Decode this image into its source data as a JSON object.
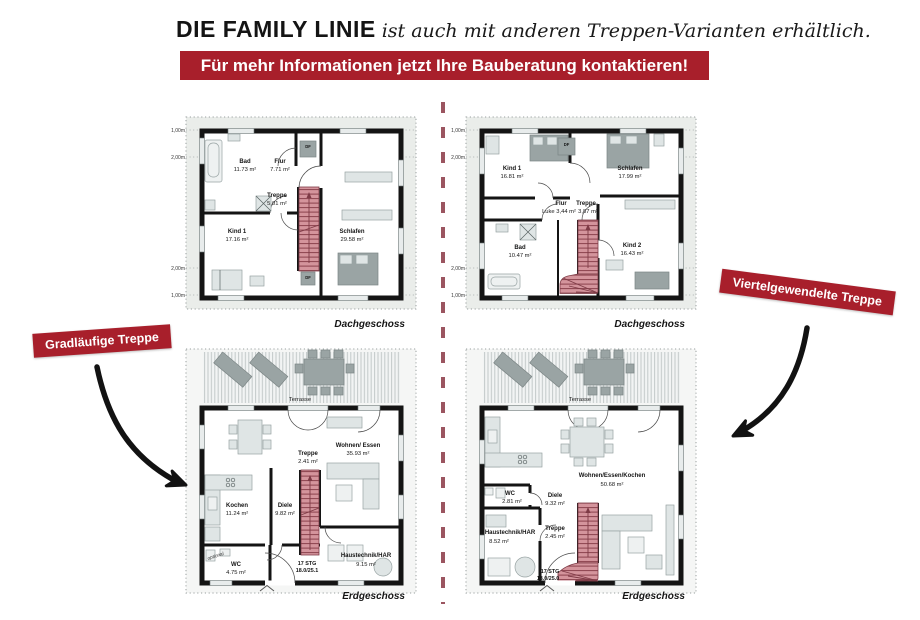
{
  "header": {
    "brand": "DIE FAMILY LINIE",
    "tagline": "ist auch mit anderen Treppen-Varianten erhältlich.",
    "banner": "Für mehr Informationen jetzt Ihre Bauberatung kontaktieren!"
  },
  "callouts": {
    "left": "Gradläufige Treppe",
    "right": "Viertelgewendelte Treppe"
  },
  "colors": {
    "accent_red": "#a81f2b",
    "stair_pink": "#d4949c",
    "divider_red": "#9b5560"
  },
  "plans": {
    "top_left": {
      "caption": "Dachgeschoss",
      "dims": [
        "1,00m",
        "2,00m",
        "2,00m",
        "1,00m"
      ],
      "roof_window": "DF",
      "rooms": {
        "bad": {
          "name": "Bad",
          "area": "11.73 m²"
        },
        "flur": {
          "name": "Flur",
          "area": "7.71 m²"
        },
        "treppe": {
          "name": "Treppe",
          "area": "5.01 m²"
        },
        "kind1": {
          "name": "Kind 1",
          "area": "17.16 m²"
        },
        "schlafen": {
          "name": "Schlafen",
          "area": "29.58 m²"
        }
      }
    },
    "top_right": {
      "caption": "Dachgeschoss",
      "dims": [
        "1,00m",
        "2,00m",
        "2,00m",
        "1,00m"
      ],
      "roof_window": "DF",
      "rooms": {
        "kind1": {
          "name": "Kind 1",
          "area": "16.81 m²"
        },
        "schlafen": {
          "name": "Schlafen",
          "area": "17.99 m²"
        },
        "flur": {
          "name": "Flur",
          "area": "Luke 3,44 m²"
        },
        "treppe": {
          "name": "Treppe",
          "area": "3,87 m²"
        },
        "bad": {
          "name": "Bad",
          "area": "10.47 m²"
        },
        "kind2": {
          "name": "Kind 2",
          "area": "16.43 m²"
        }
      }
    },
    "bottom_left": {
      "caption": "Erdgeschoss",
      "terrace": "Terrasse",
      "stair_steps": "17 STG",
      "stair_dims": "18.0/25.1",
      "rooms": {
        "kochen": {
          "name": "Kochen",
          "area": "11.24 m²"
        },
        "diele": {
          "name": "Diele",
          "area": "9.82 m²"
        },
        "treppe": {
          "name": "Treppe",
          "area": "2.41 m²"
        },
        "wohnen": {
          "name": "Wohnen/ Essen",
          "area": "35.93 m²"
        },
        "wc": {
          "name": "WC",
          "area": "4.75 m²",
          "note": "optional"
        },
        "haustechnik": {
          "name": "Haustechnik/HAR",
          "area": "9.15 m²"
        }
      }
    },
    "bottom_right": {
      "caption": "Erdgeschoss",
      "terrace": "Terrasse",
      "stair_steps": "17 STG",
      "stair_dims": "18.0/25.0",
      "rooms": {
        "wohnen": {
          "name": "Wohnen/Essen/Kochen",
          "area": "50.68 m²"
        },
        "wc": {
          "name": "WC",
          "area": "2.81 m²"
        },
        "diele": {
          "name": "Diele",
          "area": "9.32 m²"
        },
        "treppe": {
          "name": "Treppe",
          "area": "2.45 m²"
        },
        "haustechnik": {
          "name": "Haustechnik/HAR",
          "area": "8.52 m²"
        }
      }
    }
  }
}
